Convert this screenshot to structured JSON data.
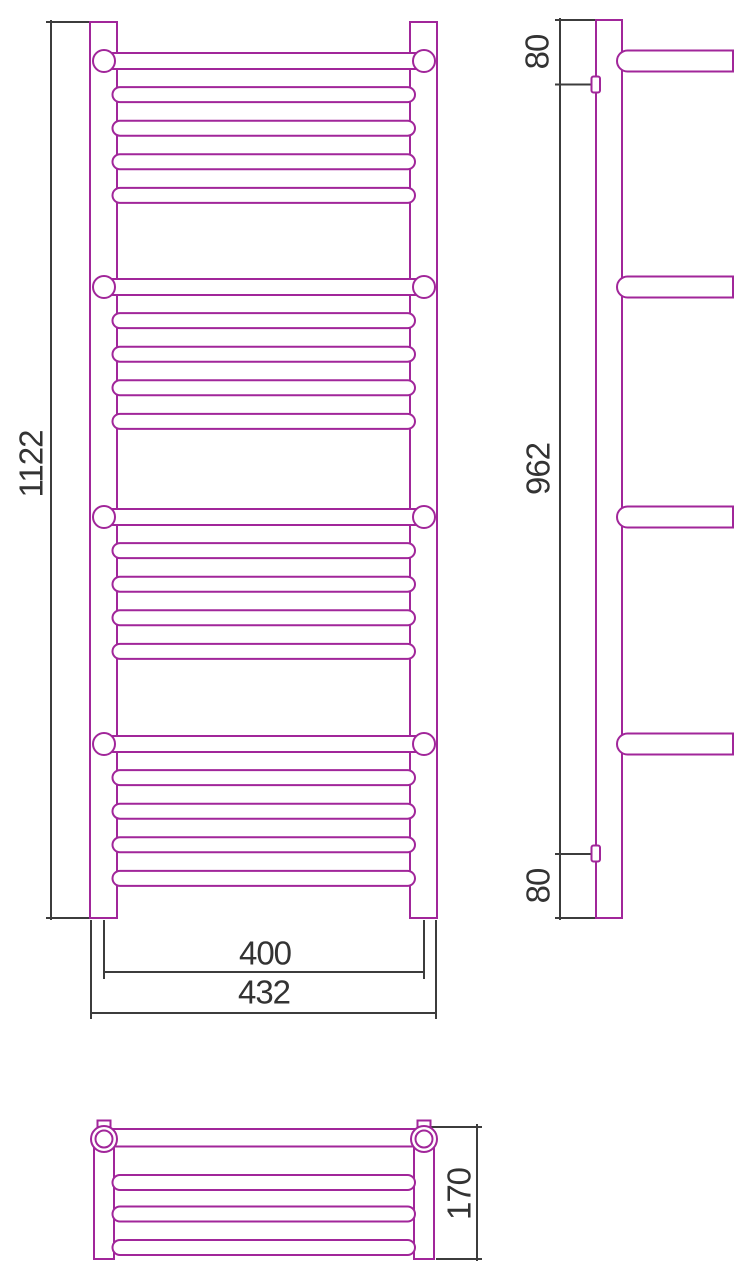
{
  "colors": {
    "drawing_line": "#A1269A",
    "dimension_line": "#3C3C3C",
    "text": "#333333",
    "background": "#FFFFFF"
  },
  "views": {
    "front": {
      "dimensions": {
        "height": "1122",
        "rail_center_width": "400",
        "overall_width": "432"
      }
    },
    "side": {
      "dimensions": {
        "top_to_bracket": "80",
        "bracket_span": "962",
        "bracket_to_bottom": "80"
      }
    },
    "plan": {
      "dimensions": {
        "depth": "170"
      }
    }
  }
}
